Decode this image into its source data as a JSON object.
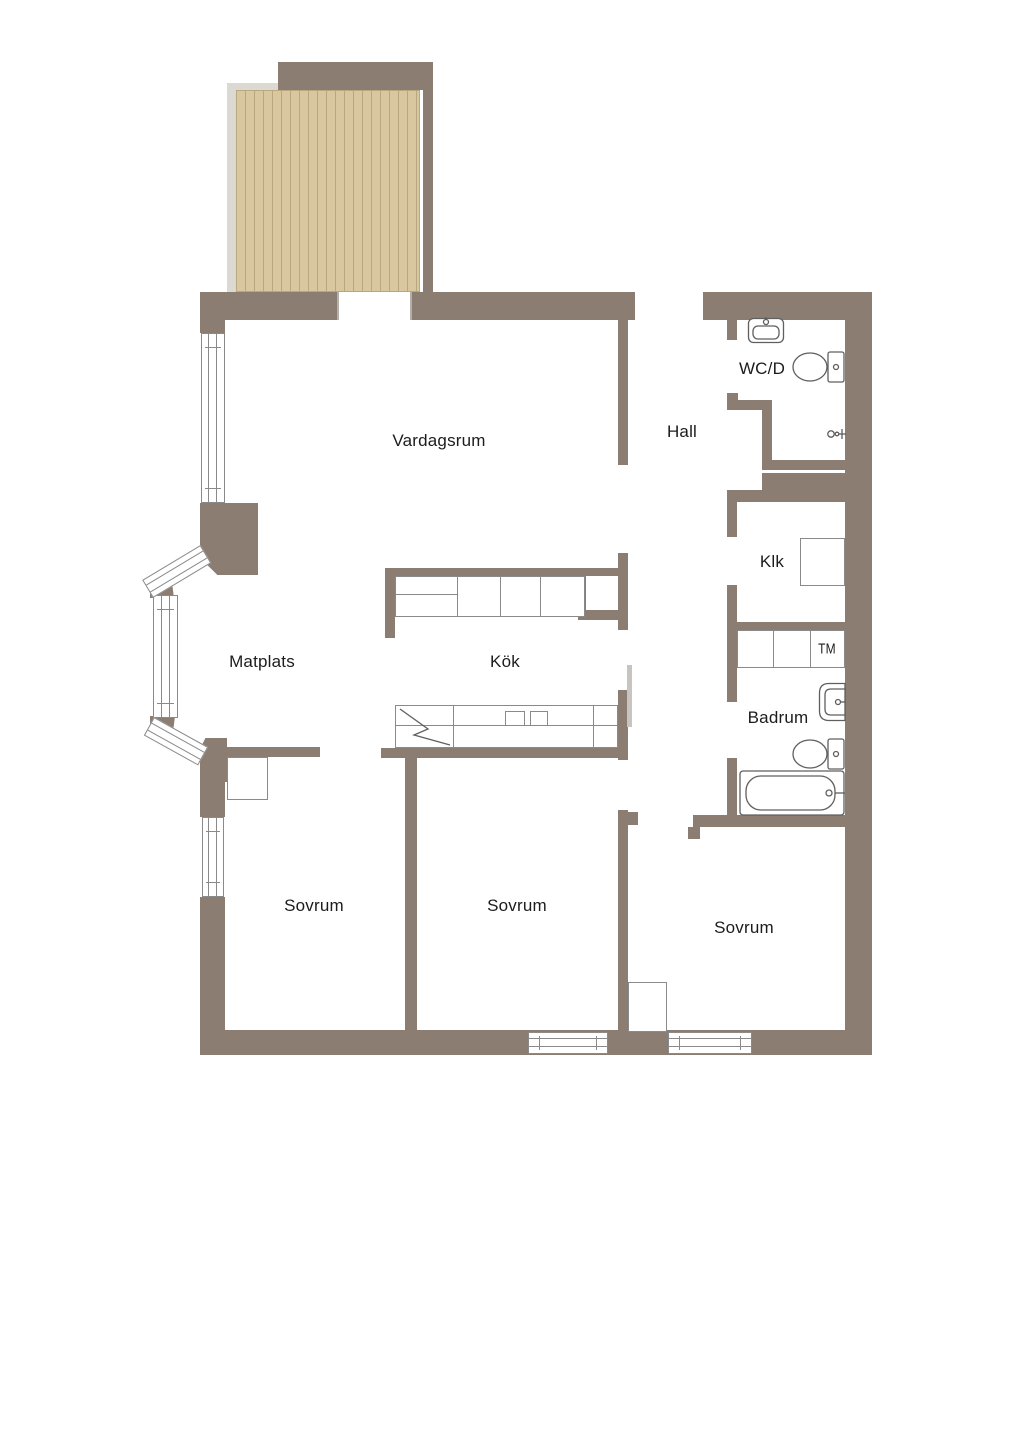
{
  "rooms": {
    "vardagsrum": {
      "label": "Vardagsrum"
    },
    "hall": {
      "label": "Hall"
    },
    "wcd": {
      "label": "WC/D"
    },
    "klk": {
      "label": "Klk"
    },
    "matplats": {
      "label": "Matplats"
    },
    "kok": {
      "label": "Kök"
    },
    "badrum": {
      "label": "Badrum"
    },
    "tm": {
      "label": "TM"
    },
    "sovrum1": {
      "label": "Sovrum"
    },
    "sovrum2": {
      "label": "Sovrum"
    },
    "sovrum3": {
      "label": "Sovrum"
    }
  },
  "colors": {
    "wall": "#8c7d72",
    "deck": "#d9c7a0",
    "deck_grain": "#b9a87f",
    "deck_trim": "#dcd8d2",
    "fixture_line": "#5f5f5f",
    "window_line": "#8a8a8a",
    "text": "#1c1c1c",
    "bg": "#ffffff"
  }
}
